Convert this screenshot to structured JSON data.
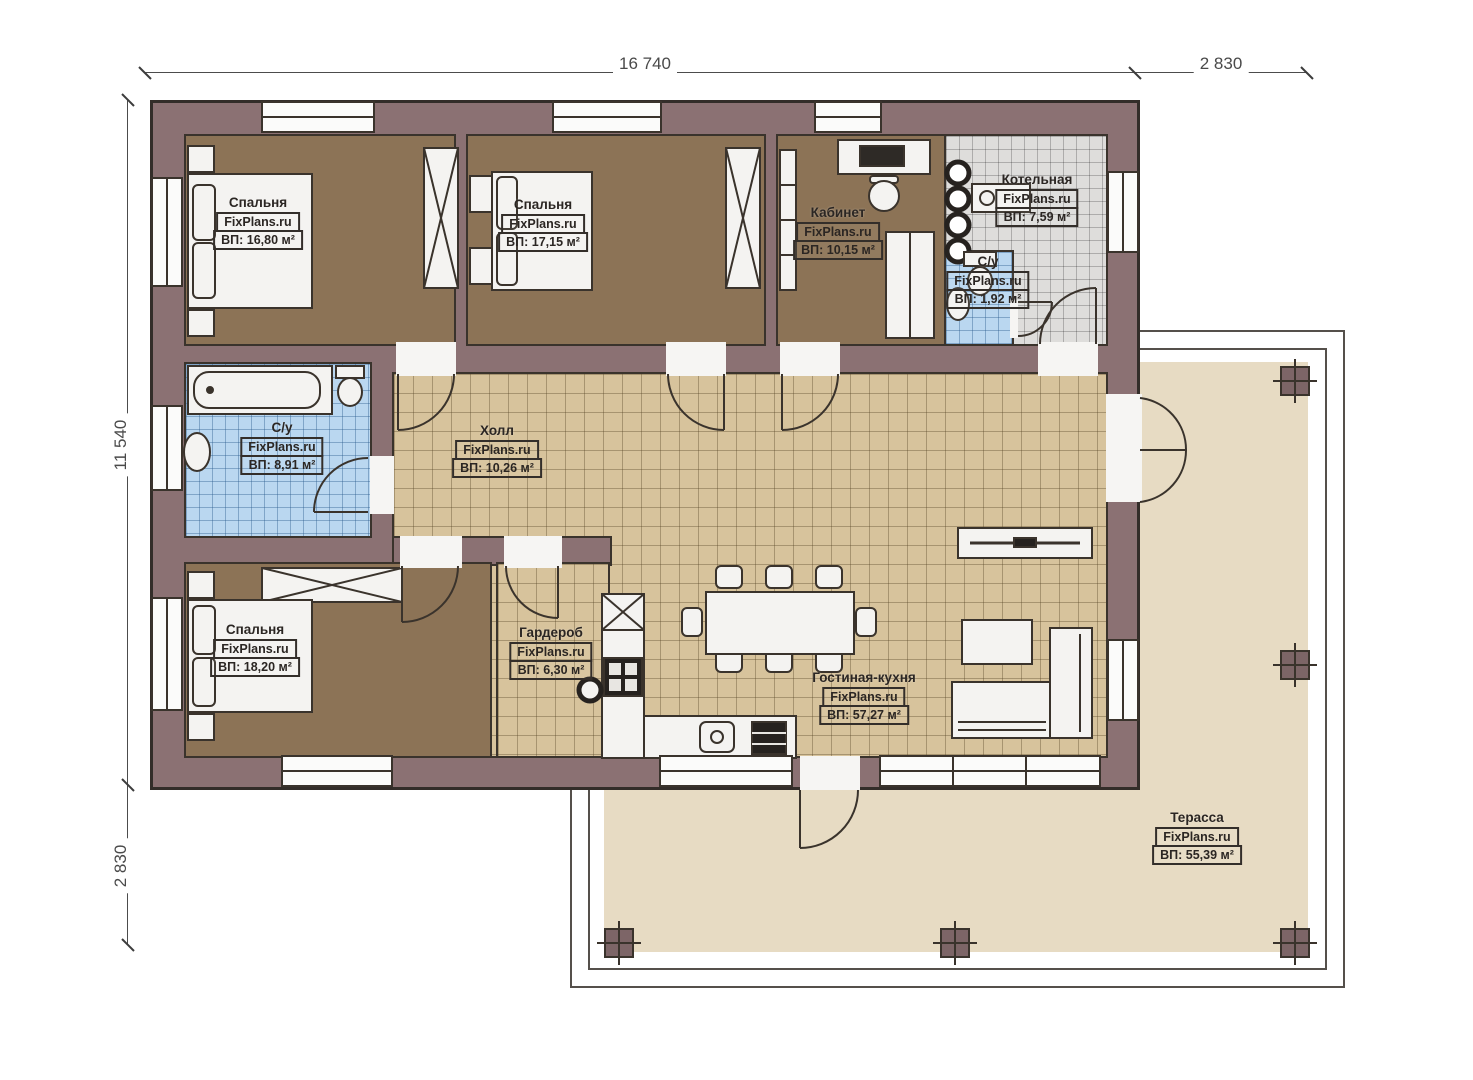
{
  "dimensions": {
    "top_main": "16 740",
    "top_secondary": "2 830",
    "left_main": "11 540",
    "left_secondary": "2 830"
  },
  "rooms": [
    {
      "id": "bedroom-1",
      "name": "Спальня",
      "brand": "FixPlans.ru",
      "area": "ВП: 16,80 м²"
    },
    {
      "id": "bedroom-2",
      "name": "Спальня",
      "brand": "FixPlans.ru",
      "area": "ВП: 17,15 м²"
    },
    {
      "id": "office",
      "name": "Кабинет",
      "brand": "FixPlans.ru",
      "area": "ВП: 10,15 м²"
    },
    {
      "id": "boiler-room",
      "name": "Котельная",
      "brand": "FixPlans.ru",
      "area": "ВП: 7,59 м²"
    },
    {
      "id": "wc-small",
      "name": "С/у",
      "brand": "FixPlans.ru",
      "area": "ВП: 1,92 м²"
    },
    {
      "id": "bathroom",
      "name": "С/у",
      "brand": "FixPlans.ru",
      "area": "ВП: 8,91 м²"
    },
    {
      "id": "hall",
      "name": "Холл",
      "brand": "FixPlans.ru",
      "area": "ВП: 10,26 м²"
    },
    {
      "id": "bedroom-3",
      "name": "Спальня",
      "brand": "FixPlans.ru",
      "area": "ВП: 18,20 м²"
    },
    {
      "id": "wardrobe-room",
      "name": "Гардероб",
      "brand": "FixPlans.ru",
      "area": "ВП: 6,30 м²"
    },
    {
      "id": "living-kitchen",
      "name": "Гостиная-кухня",
      "brand": "FixPlans.ru",
      "area": "ВП: 57,27 м²"
    },
    {
      "id": "terrace",
      "name": "Терасса",
      "brand": "FixPlans.ru",
      "area": "ВП: 55,39 м²"
    }
  ],
  "colors": {
    "wall": "#8b7173",
    "wood_floor": "#8c7356",
    "tile_beige": "#d7c39c",
    "tile_blue": "#bad7f0",
    "tile_gray": "#dedddb",
    "terrace": "#e7dbc3",
    "outline": "#3a332c"
  }
}
